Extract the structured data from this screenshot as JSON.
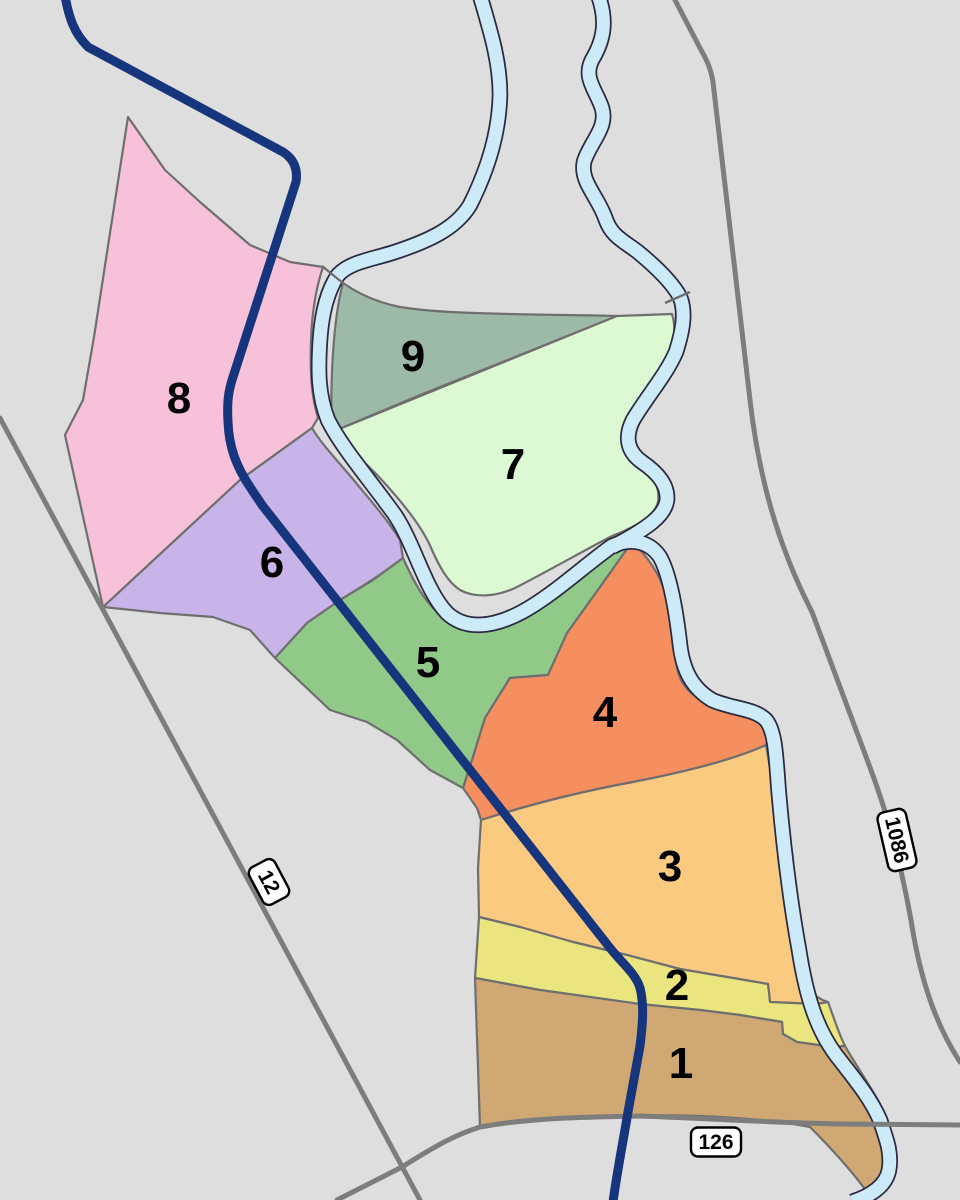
{
  "map": {
    "background_color": "#dedede",
    "boundary_color": "#6f6f6f",
    "regions": [
      {
        "id": 1,
        "label": "1",
        "color": "#cfa873"
      },
      {
        "id": 2,
        "label": "2",
        "color": "#eae57e"
      },
      {
        "id": 3,
        "label": "3",
        "color": "#f9ca80"
      },
      {
        "id": 4,
        "label": "4",
        "color": "#f68f60"
      },
      {
        "id": 5,
        "label": "5",
        "color": "#90c988"
      },
      {
        "id": 6,
        "label": "6",
        "color": "#c8b4e9"
      },
      {
        "id": 7,
        "label": "7",
        "color": "#dcf9d4"
      },
      {
        "id": 8,
        "label": "8",
        "color": "#f8c1da"
      },
      {
        "id": 9,
        "label": "9",
        "color": "#9db9a8"
      }
    ],
    "river": {
      "water_color": "#cdeaf9",
      "outline_color": "#2a2a40"
    },
    "roads": {
      "color": "#7d7d7d"
    },
    "route_line": {
      "color": "#16357d"
    },
    "route_shields": [
      {
        "label": "12"
      },
      {
        "label": "1086"
      },
      {
        "label": "126"
      }
    ]
  }
}
